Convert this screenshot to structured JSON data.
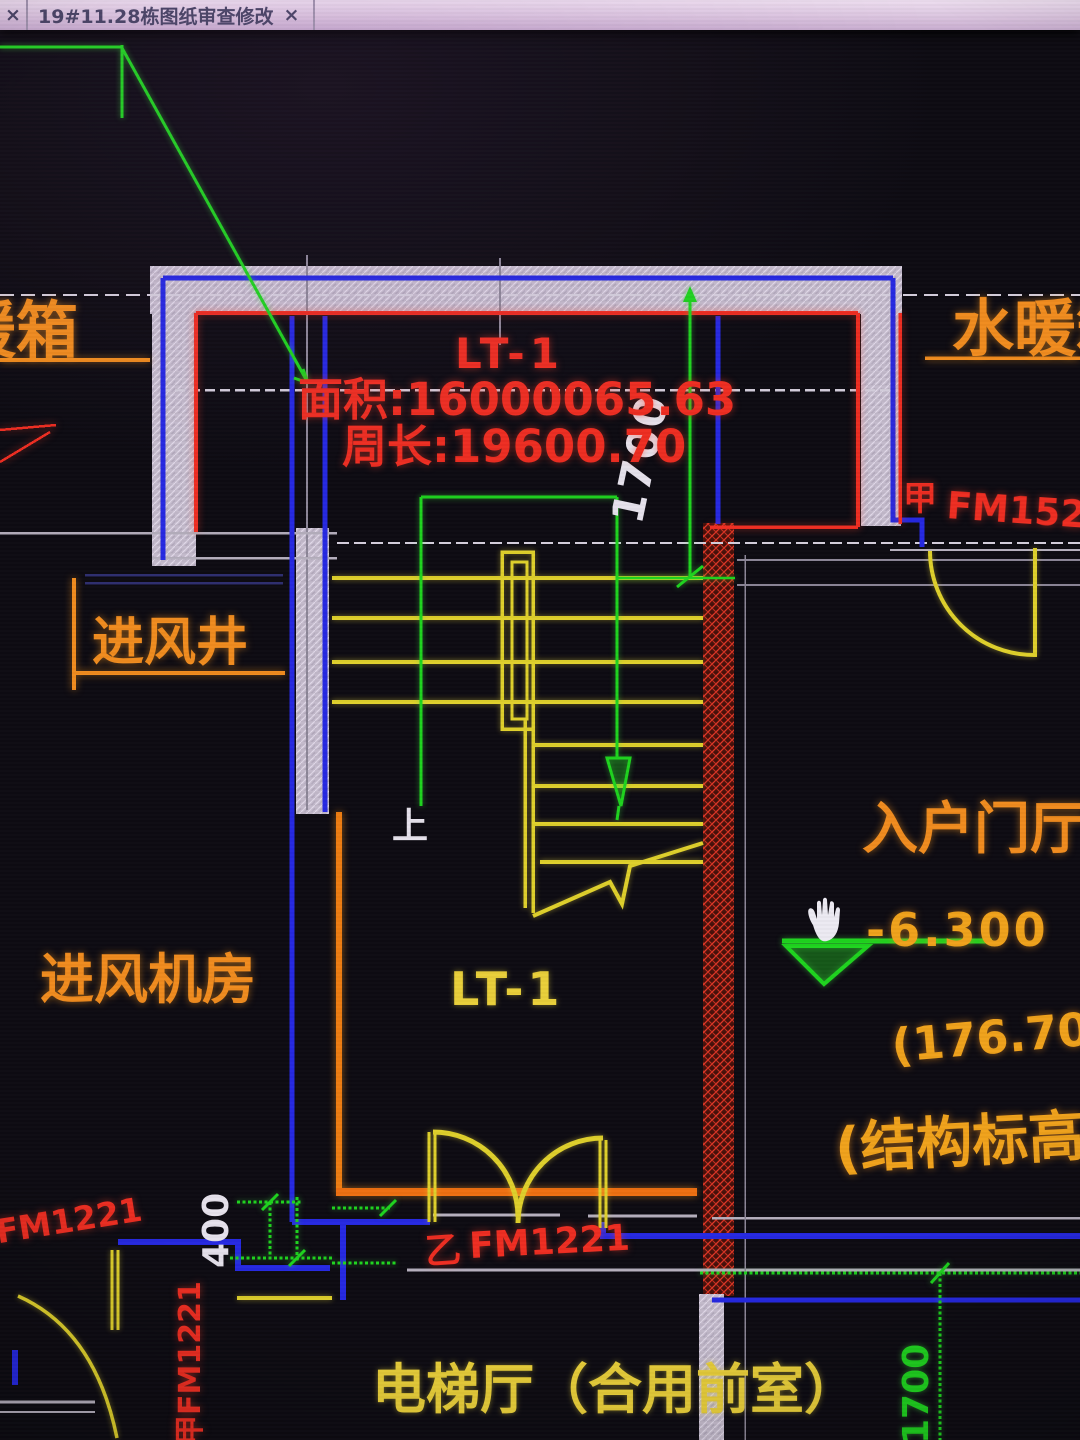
{
  "tab_bar": {
    "prev_tab_close": "×",
    "active_tab": "19#11.28栋图纸审查修改",
    "active_tab_close": "×"
  },
  "annotations": {
    "duct_box_left": "暖箱",
    "duct_box_right": "水暖箱",
    "stair_name_top": "LT-1",
    "area": "面积:16000065.63",
    "perimeter": "周长:19600.70",
    "dim_stair_1700": "1700",
    "door_a_right_prefix": "甲",
    "door_a_right_code": "FM1521",
    "air_inlet_shaft": "进风井",
    "air_inlet_room": "进风机房",
    "up_mark": "上",
    "stair_label": "LT-1",
    "entry_hall": "入户门厅",
    "elevation": "-6.300",
    "structural_elevation_value": "(176.700",
    "structural_elevation_label": "(结构标高)",
    "door_b_bottom_prefix": "乙",
    "door_b_bottom_code": "FM1221",
    "door_left_edge_code": "FM1221",
    "door_a_left_vertical": "甲FM1221",
    "dim_400": "400",
    "elevator_hall": "电梯厅（合用前室）",
    "dim_bottom_1700": "1700"
  },
  "colors": {
    "background": "#0e0c13",
    "wall_fill": "#c3bacb",
    "red": "#ee2e22",
    "orange": "#f08c1f",
    "gold": "#f0a21c",
    "yellow": "#dfd02c",
    "green": "#1fd41f",
    "blue": "#2629e2",
    "gray": "#b6b0be",
    "tab_bg": "#ddc9e0"
  }
}
